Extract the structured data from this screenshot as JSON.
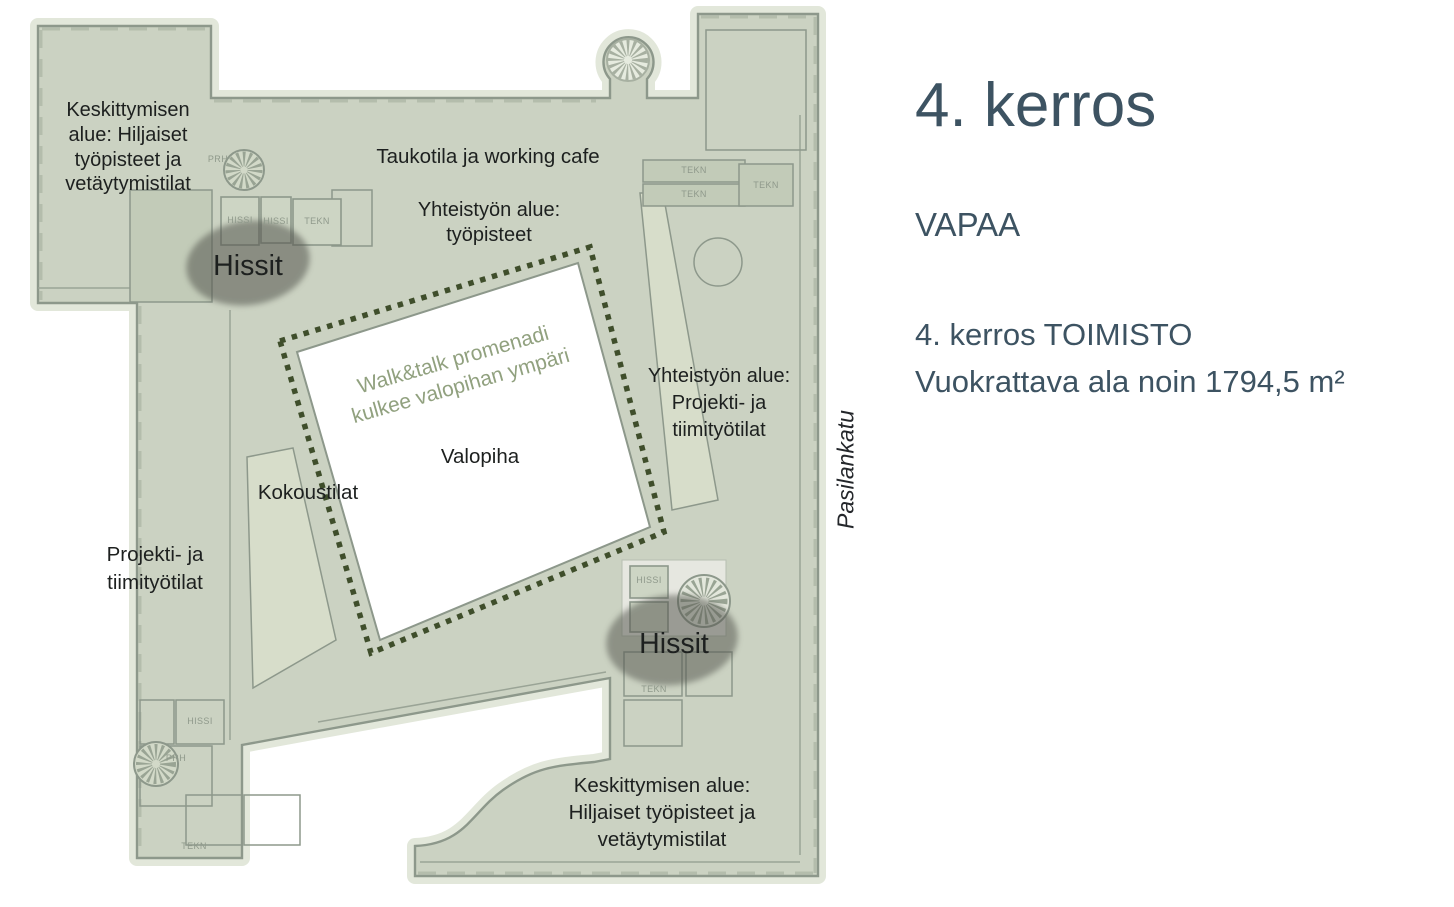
{
  "panel": {
    "title": "4. kerros",
    "status": "VAPAA",
    "office_line": "4. kerros TOIMISTO",
    "area_line": "Vuokrattava ala noin 1794,5 m²"
  },
  "plan": {
    "street": "Pasilankatu",
    "labels": {
      "focus_top": "Keskittymisen\nalue: Hiljaiset\ntyöpisteet ja\nvetäytymistilat",
      "break_cafe": "Taukotila ja working cafe",
      "collab_workstations": "Yhteistyön alue:\ntyöpisteet",
      "elevators_top": "Hissit",
      "promenade": "Walk&talk promenadi\nkulkee valopihan ympäri",
      "lightwell": "Valopiha",
      "meeting_rooms": "Kokoustilat",
      "collab_project": "Yhteistyön alue:\nProjekti- ja\ntiimityötilat",
      "project_team": "Projekti- ja\ntiimityötilat",
      "elevators_bottom": "Hissit",
      "focus_bottom": "Keskittymisen alue:\nHiljaiset työpisteet ja\nvetäytymistilat"
    },
    "room_tags": {
      "elevator": "HISSI",
      "technical": "TEKN",
      "stair": "PRH"
    }
  },
  "colors": {
    "panel_text": "#3d5362",
    "label_text": "#1d201f",
    "promenade_text": "#91a17f",
    "street_text": "#24272b",
    "dot_green": "#3f4e2b",
    "plan_fill": "#cbd2c2",
    "plan_pale": "#d7ddca",
    "plan_dark": "#c2cbb8",
    "plan_halo": "#e2e7da",
    "wall": "#8d988b",
    "blob": "#54564f"
  }
}
